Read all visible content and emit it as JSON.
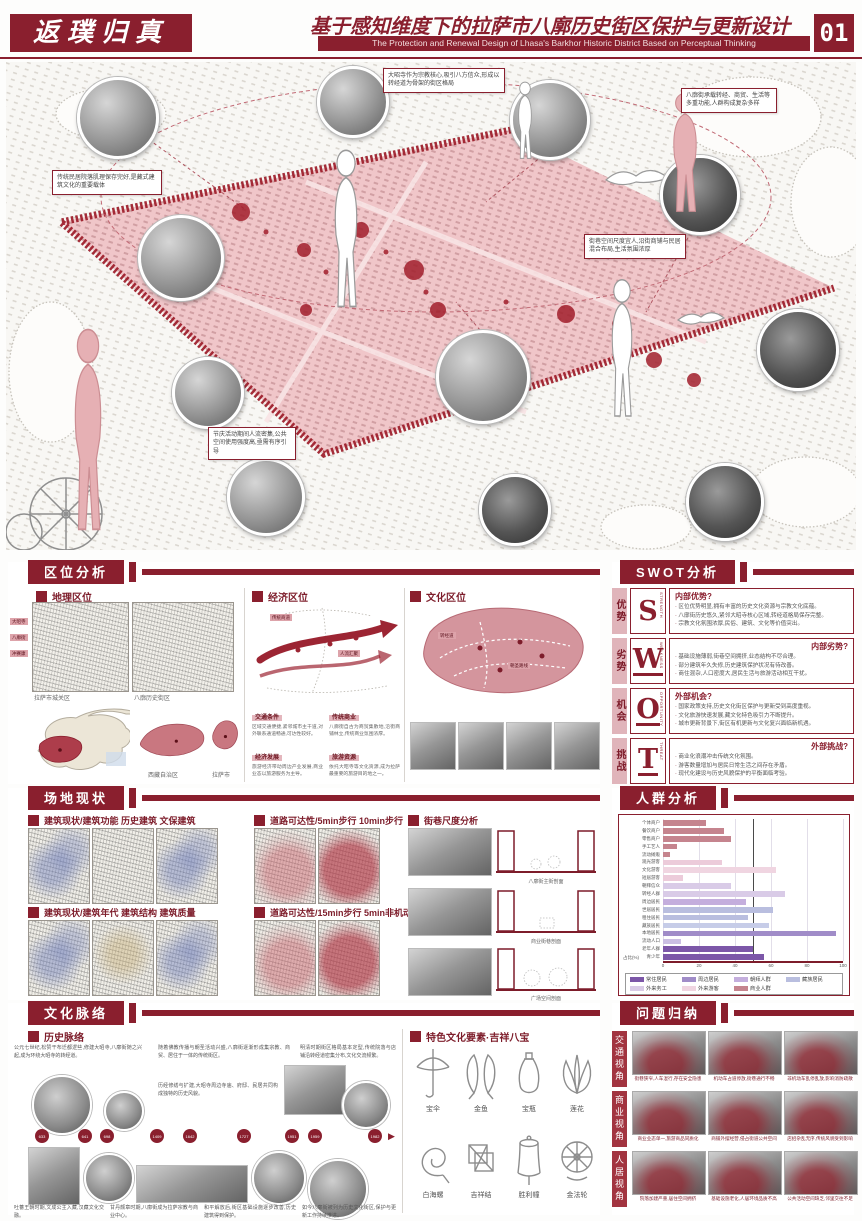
{
  "header": {
    "logo": "返璞归真",
    "title_cn": "基于感知维度下的拉萨市八廓历史街区保护与更新设计",
    "title_en": "The Protection and Renewal Design of Lhasa's Barkhor Historic District Based on Perceptual Thinking",
    "page_no": "01"
  },
  "hero": {
    "annotations": [
      "大昭寺作为宗教核心,吸引八方信众,形成以转经道为骨架的街区格局",
      "传统民居院落肌理保存完好,是藏式建筑文化的重要载体",
      "八廓街承载转经、商贸、生活等多重功能,人群构成复杂多样",
      "街巷空间尺度宜人,沿街商铺与民居混合布局,生活氛围浓厚",
      "节庆活动期间人流密集,公共空间使用强度高,亟需有序引导"
    ]
  },
  "location": {
    "title": "区位分析",
    "subs": [
      "地理区位",
      "经济区位",
      "文化区位"
    ],
    "geo": {
      "captions": [
        "拉萨市城关区",
        "八廓历史街区"
      ],
      "region_labels": [
        "西藏自治区",
        "拉萨市"
      ],
      "chips": [
        "大昭寺",
        "八廓街",
        "冲赛康"
      ]
    },
    "econ": {
      "chips": [
        "传统商道",
        "人流汇聚"
      ],
      "blocks": [
        {
          "h": "交通条件",
          "b": "区域交通便捷,紧邻城市主干道,对外联系通道畅通,可达性较好。"
        },
        {
          "h": "传统商业",
          "b": "八廓街自古为商贸集散地,沿街商铺林立,传统商业氛围浓厚。"
        },
        {
          "h": "经济发展",
          "b": "旅游经济带动周边产业发展,商业业态以旅游服务为主导。"
        },
        {
          "h": "旅游资源",
          "b": "依托大昭寺等文化资源,成为拉萨最重要的旅游目的地之一。"
        }
      ]
    },
    "culture_chips": [
      "转经道",
      "朝圣路线"
    ]
  },
  "swot": {
    "title": "SWOT分析",
    "rows": [
      {
        "cn": "优势",
        "letter": "S",
        "en": "STRENGTH",
        "heading": "内部优势?",
        "align": "left",
        "underline": false,
        "bullets": [
          "区位优势明显,拥有丰富的历史文化资源与宗教文化底蕴。",
          "八廓街历史悠久,紧邻大昭寺核心区域,转经道格局保存完整。",
          "宗教文化氛围浓厚,民俗、建筑、文化等价值突出。"
        ]
      },
      {
        "cn": "劣势",
        "letter": "W",
        "en": "WEAKNESS",
        "heading": "内部劣势?",
        "align": "right",
        "underline": true,
        "bullets": [
          "基础设施薄弱,街巷空间拥挤,业态结构不尽合理。",
          "部分建筑年久失修,历史建筑保护状况有待改善。",
          "商住混杂,人口密度大,居民生活与旅游活动相互干扰。"
        ]
      },
      {
        "cn": "机会",
        "letter": "O",
        "en": "OPPORTUNITY",
        "heading": "外部机会?",
        "align": "left",
        "underline": true,
        "bullets": [
          "国家政策支持,历史文化街区保护与更新受到高度重视。",
          "文化旅游快速发展,藏文化特色吸引力不断提升。",
          "城市更新背景下,街区有机更新与文化复兴面临新机遇。"
        ]
      },
      {
        "cn": "挑战",
        "letter": "T",
        "en": "THREAT",
        "heading": "外部挑战?",
        "align": "right",
        "underline": true,
        "bullets": [
          "商业化浪潮冲击传统文化氛围。",
          "游客数量增加与居民日常生活之间存在矛盾。",
          "现代化建设与历史风貌保护的平衡面临考验。"
        ]
      }
    ]
  },
  "site": {
    "title": "场地现状",
    "labels": [
      "建筑现状/建筑功能 历史建筑 文保建筑",
      "道路可达性/5min步行 10min步行",
      "建筑现状/建筑年代 建筑结构 建筑质量",
      "道路可达性/15min步行 5min非机动车"
    ],
    "street": {
      "label": "街巷尺度分析",
      "captions": [
        "八廓街主街剖面",
        "商业街巷剖面",
        "广场空间剖面"
      ]
    }
  },
  "chart_data": {
    "type": "bar",
    "orientation": "horizontal",
    "title": "人群分析",
    "categories": [
      "个体商户",
      "餐饮商户",
      "零售商户",
      "手工艺人",
      "流动摊贩",
      "观光游客",
      "文化游客",
      "短居游客",
      "朝拜信众",
      "转经人群",
      "周边居民",
      "世居居民",
      "租住居民",
      "藏族居民",
      "本地居民",
      "流动人口",
      "老年人群",
      "青少年"
    ],
    "values": [
      24,
      34,
      38,
      8,
      4,
      33,
      63,
      11,
      38,
      68,
      46,
      61,
      47,
      59,
      96,
      10,
      50,
      56
    ],
    "colors": [
      "#c5848e",
      "#c5848e",
      "#c5848e",
      "#c5848e",
      "#c5848e",
      "#eccbda",
      "#f0d5e1",
      "#eccbda",
      "#d9cbe7",
      "#d9cbe7",
      "#c4aedd",
      "#b9bedf",
      "#b9bedf",
      "#c6cce8",
      "#a08cc8",
      "#cbbfe3",
      "#7c57a8",
      "#7c57a8"
    ],
    "xlim": [
      0,
      100
    ],
    "x_ticks": [
      0,
      20,
      40,
      60,
      80,
      100
    ],
    "ref_line": 50,
    "unit": "占比(%)",
    "legend": [
      {
        "label": "常住居民",
        "color": "#7c57a8"
      },
      {
        "label": "周边居民",
        "color": "#a08cc8"
      },
      {
        "label": "朝拜人群",
        "color": "#c4aedd"
      },
      {
        "label": "藏族居民",
        "color": "#b9bedf"
      },
      {
        "label": "外来务工",
        "color": "#d9cbe7"
      },
      {
        "label": "外来游客",
        "color": "#f0d5e1"
      },
      {
        "label": "商业人群",
        "color": "#c5848e"
      }
    ]
  },
  "culture": {
    "title": "文化脉络",
    "sub": "历史脉络",
    "feature_label": "特色文化要素·吉祥八宝",
    "symbols": [
      "宝伞",
      "金鱼",
      "宝瓶",
      "莲花",
      "白海螺",
      "吉祥结",
      "胜利幢",
      "金法轮"
    ],
    "years": [
      "633",
      "641",
      "698",
      "1409",
      "1642",
      "1727",
      "1951",
      "1959",
      "1982"
    ],
    "year_x": [
      27,
      70,
      92,
      142,
      175,
      229,
      277,
      300,
      360
    ],
    "arrow": "▶",
    "paragraphs": [
      "公元七世纪,松赞干布迁都逻些,修建大昭寺,八廓街随之兴起,成为环绕大昭寺的转经道。",
      "随着佛教传播与朝圣活动兴盛,八廓街逐渐形成集宗教、商贸、居住于一体的传统街区。",
      "明清时期街区格局基本定型,传统院落与店铺沿转经道密集分布,文化交流频繁。",
      "历经修缮与扩建,大昭寺周边寺庙、府邸、民居共同构成独特的历史风貌。",
      "吐蕃王朝时期,文成公主入藏,汉藏文化交融。",
      "甘丹颇章时期,八廓街成为拉萨宗教与商业中心。",
      "和平解放后,街区基础设施逐步改善,历史建筑得到保护。",
      "如今八廓街被列为历史文化街区,保护与更新工作持续推进。"
    ]
  },
  "problems": {
    "title": "问题归纳",
    "tabs": [
      "交通视角",
      "商业视角",
      "人居视角"
    ],
    "captions": [
      "街巷狭窄,人车混行,存在安全隐患",
      "机动车占道停放,街巷通行不畅",
      "非机动车乱停乱放,影响消防疏散",
      "商业业态单一,旅游商品同质化",
      "商铺外摆经营,侵占街道公共空间",
      "店招杂乱无序,传统风貌受到影响",
      "院落加建严重,居住空间拥挤",
      "基础设施老化,人居环境品质不高",
      "公共活动空间缺乏,邻里交往不足"
    ]
  }
}
